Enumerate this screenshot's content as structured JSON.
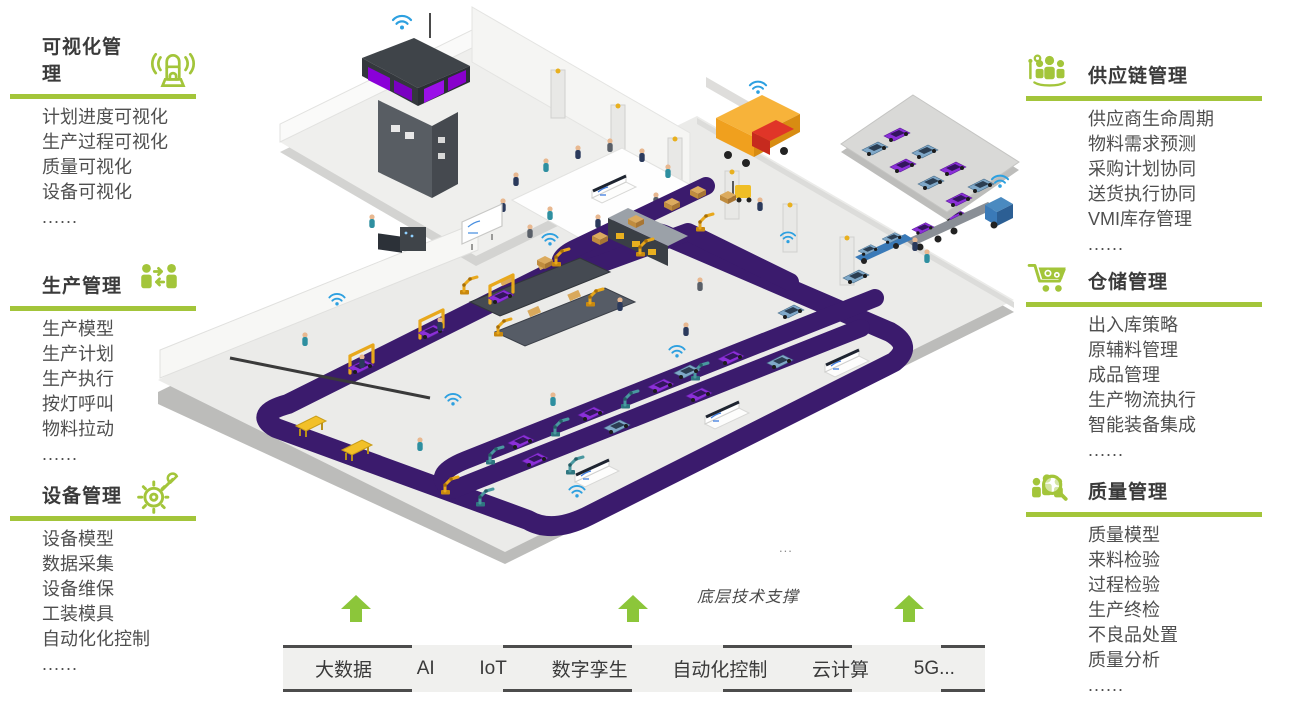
{
  "palette": {
    "accent_green": "#a3c53a",
    "arrow_green": "#8cc63a",
    "conveyor_purple": "#3b1b6d",
    "car_purple": "#8b2fd8",
    "car_blue": "#7fa8c8",
    "robot_yellow": "#e8a81c",
    "robot_teal": "#4a98a0",
    "wifi_blue": "#2da0e0",
    "truck_orange": "#f0a01e",
    "truck_cab_red": "#d93025",
    "carrier_cab_blue": "#3a7ab8",
    "title_text": "#3a3a3a",
    "body_text": "#4f4f4f",
    "bar_bg": "#f0f0ee",
    "bar_border": "#4c4c4c"
  },
  "left_sections": [
    {
      "title": "可视化管理",
      "icon": "beacon-icon",
      "items": [
        "计划进度可视化",
        "生产过程可视化",
        "质量可视化",
        "设备可视化",
        "......"
      ]
    },
    {
      "title": "生产管理",
      "icon": "people-exchange-icon",
      "items": [
        "生产模型",
        "生产计划",
        "生产执行",
        "按灯呼叫",
        "物料拉动",
        "......"
      ]
    },
    {
      "title": "设备管理",
      "icon": "gear-wrench-icon",
      "items": [
        "设备模型",
        "数据采集",
        "设备维保",
        "工装模具",
        "自动化化控制",
        "......"
      ]
    }
  ],
  "right_sections": [
    {
      "title": "供应链管理",
      "icon": "supply-chain-people-icon",
      "items": [
        "供应商生命周期",
        "物料需求预测",
        "采购计划协同",
        "送货执行协同",
        "VMI库存管理",
        "......"
      ]
    },
    {
      "title": "仓储管理",
      "icon": "cart-gears-icon",
      "items": [
        "出入库策略",
        "原辅料管理",
        "成品管理",
        "生产物流执行",
        "智能装备集成",
        "......"
      ]
    },
    {
      "title": "质量管理",
      "icon": "magnifier-people-icon",
      "items": [
        "质量模型",
        "来料检验",
        "过程检验",
        "生产终检",
        "不良品处置",
        "质量分析",
        "......"
      ]
    }
  ],
  "bottom": {
    "support_label": "底层技术支撑",
    "ellipsis": "...",
    "technologies": [
      "大数据",
      "AI",
      "IoT",
      "数字孪生",
      "自动化控制",
      "云计算",
      "5G..."
    ]
  }
}
